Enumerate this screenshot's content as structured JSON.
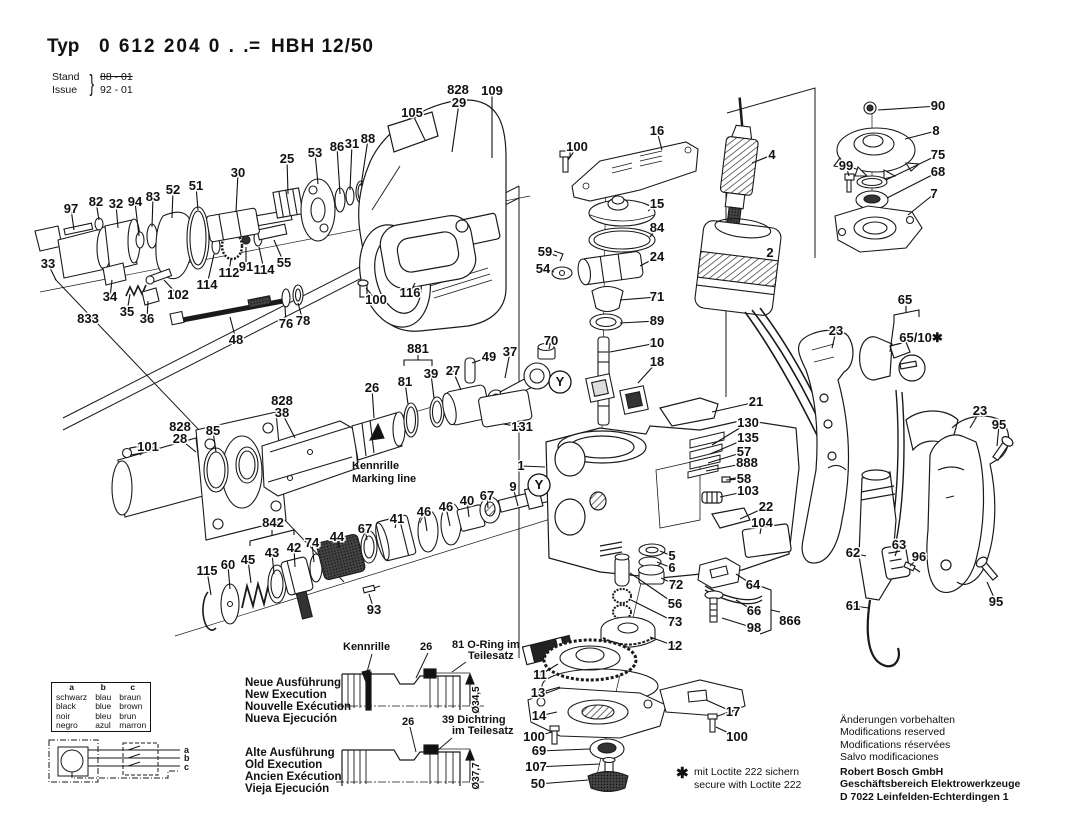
{
  "header": {
    "typ_label": "Typ",
    "typ_value": "0 612 204 0 . .",
    "equals": "=",
    "model": "HBH 12/50",
    "stand_label": "Stand",
    "issue_label": "Issue",
    "brace": "}",
    "stand_value": "88 - 01",
    "issue_value": "92 - 01"
  },
  "colors": {
    "ink": "#1a1a1a",
    "label": "#111111",
    "background": "#ffffff"
  },
  "notes": {
    "kennrille": [
      "Kennrille",
      "Marking line"
    ],
    "loctite_star": "✱",
    "loctite": [
      "mit Loctite 222 sichern",
      "secure with Loctite 222"
    ]
  },
  "executions": {
    "new": {
      "names": [
        "Neue Ausführung",
        "New Execution",
        "Nouvelle Exécution",
        "Nueva Ejecución"
      ],
      "callout_kennrille": "Kennrille",
      "callout_26": "26",
      "callout_81": "81 O-Ring im",
      "callout_81b": "Teilesatz",
      "dia": "Ø34,5"
    },
    "old": {
      "names": [
        "Alte Ausführung",
        "Old Execution",
        "Ancien Exécution",
        "Vieja Ejecución"
      ],
      "callout_26": "26",
      "callout_39": "39 Dichtring",
      "callout_39b": "im Teilesatz",
      "dia": "Ø37,7"
    }
  },
  "color_table": {
    "headers": [
      "a",
      "b",
      "c"
    ],
    "rows": [
      [
        "schwarz",
        "blau",
        "braun"
      ],
      [
        "black",
        "blue",
        "brown"
      ],
      [
        "noir",
        "bleu",
        "brun"
      ],
      [
        "negro",
        "azul",
        "marron"
      ]
    ]
  },
  "wiring": {
    "terminals": [
      "a",
      "b",
      "c"
    ]
  },
  "footer": {
    "notices": [
      "Änderungen vorbehalten",
      "Modifications reserved",
      "Modifications réservées",
      "Salvo modificaciones"
    ],
    "company": [
      "Robert Bosch GmbH",
      "Geschäftsbereich Elektrowerkzeuge",
      "D 7022 Leinfelden-Echterdingen 1"
    ]
  },
  "y_markers": [
    {
      "x": 560,
      "y": 382
    },
    {
      "x": 539,
      "y": 485
    }
  ],
  "part_labels": [
    {
      "t": "105",
      "x": 412,
      "y": 113,
      "lx": 425,
      "ly": 140
    },
    {
      "t": "828",
      "x": 458,
      "y": 90
    },
    {
      "t": "29",
      "x": 459,
      "y": 103,
      "lx": 452,
      "ly": 152
    },
    {
      "t": "109",
      "x": 492,
      "y": 91,
      "lx": 492,
      "ly": 158
    },
    {
      "t": "88",
      "x": 368,
      "y": 139,
      "lx": 361,
      "ly": 186
    },
    {
      "t": "31",
      "x": 352,
      "y": 144,
      "lx": 350,
      "ly": 190
    },
    {
      "t": "86",
      "x": 337,
      "y": 147,
      "lx": 340,
      "ly": 194
    },
    {
      "t": "53",
      "x": 315,
      "y": 153,
      "lx": 318,
      "ly": 184
    },
    {
      "t": "25",
      "x": 287,
      "y": 159,
      "lx": 288,
      "ly": 194
    },
    {
      "t": "30",
      "x": 238,
      "y": 173,
      "lx": 236,
      "ly": 212
    },
    {
      "t": "51",
      "x": 196,
      "y": 186,
      "lx": 198,
      "ly": 210
    },
    {
      "t": "52",
      "x": 173,
      "y": 190,
      "lx": 172,
      "ly": 218
    },
    {
      "t": "83",
      "x": 153,
      "y": 197,
      "lx": 152,
      "ly": 227
    },
    {
      "t": "94",
      "x": 135,
      "y": 202,
      "lx": 139,
      "ly": 236
    },
    {
      "t": "32",
      "x": 116,
      "y": 204,
      "lx": 118,
      "ly": 228
    },
    {
      "t": "82",
      "x": 96,
      "y": 202,
      "lx": 99,
      "ly": 220
    },
    {
      "t": "97",
      "x": 71,
      "y": 209,
      "lx": 74,
      "ly": 230
    },
    {
      "t": "33",
      "x": 48,
      "y": 264,
      "lx": 56,
      "ly": 280
    },
    {
      "t": "34",
      "x": 110,
      "y": 297,
      "lx": 112,
      "ly": 280
    },
    {
      "t": "35",
      "x": 127,
      "y": 312,
      "lx": 130,
      "ly": 294
    },
    {
      "t": "36",
      "x": 147,
      "y": 319,
      "lx": 148,
      "ly": 301
    },
    {
      "t": "833",
      "x": 88,
      "y": 319
    },
    {
      "t": "102",
      "x": 178,
      "y": 295,
      "lx": 164,
      "ly": 280
    },
    {
      "t": "114",
      "x": 207,
      "y": 285,
      "lx": 214,
      "ly": 254
    },
    {
      "t": "112",
      "x": 229,
      "y": 273,
      "lx": 231,
      "ly": 258
    },
    {
      "t": "91",
      "x": 246,
      "y": 267,
      "lx": 246,
      "ly": 247
    },
    {
      "t": "114",
      "x": 264,
      "y": 270,
      "lx": 259,
      "ly": 247
    },
    {
      "t": "55",
      "x": 284,
      "y": 263,
      "lx": 274,
      "ly": 240
    },
    {
      "t": "76",
      "x": 286,
      "y": 324,
      "lx": 285,
      "ly": 306
    },
    {
      "t": "78",
      "x": 303,
      "y": 321,
      "lx": 298,
      "ly": 303
    },
    {
      "t": "48",
      "x": 236,
      "y": 340,
      "lx": 230,
      "ly": 317
    },
    {
      "t": "100",
      "x": 376,
      "y": 300,
      "lx": 366,
      "ly": 288
    },
    {
      "t": "116",
      "x": 410,
      "y": 293,
      "lx": 415,
      "ly": 283
    },
    {
      "t": "100",
      "x": 577,
      "y": 147,
      "lx": 568,
      "ly": 160
    },
    {
      "t": "16",
      "x": 657,
      "y": 131,
      "lx": 662,
      "ly": 150
    },
    {
      "t": "15",
      "x": 657,
      "y": 204,
      "lx": 648,
      "ly": 211
    },
    {
      "t": "84",
      "x": 657,
      "y": 228,
      "lx": 650,
      "ly": 237
    },
    {
      "t": "24",
      "x": 657,
      "y": 257,
      "lx": 640,
      "ly": 266
    },
    {
      "t": "59",
      "x": 545,
      "y": 252,
      "lx": 557,
      "ly": 256
    },
    {
      "t": "54",
      "x": 543,
      "y": 269,
      "lx": 554,
      "ly": 272
    },
    {
      "t": "71",
      "x": 657,
      "y": 297,
      "lx": 620,
      "ly": 300
    },
    {
      "t": "89",
      "x": 657,
      "y": 321,
      "lx": 620,
      "ly": 323
    },
    {
      "t": "10",
      "x": 657,
      "y": 343,
      "lx": 610,
      "ly": 352
    },
    {
      "t": "18",
      "x": 657,
      "y": 362,
      "lx": 638,
      "ly": 383
    },
    {
      "t": "70",
      "x": 551,
      "y": 341,
      "lx": 549,
      "ly": 349
    },
    {
      "t": "90",
      "x": 938,
      "y": 106,
      "lx": 878,
      "ly": 110
    },
    {
      "t": "8",
      "x": 936,
      "y": 131,
      "lx": 905,
      "ly": 139
    },
    {
      "t": "75",
      "x": 938,
      "y": 155,
      "lx": 886,
      "ly": 180
    },
    {
      "t": "68",
      "x": 938,
      "y": 172,
      "lx": 887,
      "ly": 198
    },
    {
      "t": "7",
      "x": 934,
      "y": 194,
      "lx": 908,
      "ly": 215
    },
    {
      "t": "99",
      "x": 846,
      "y": 166,
      "lx": 849,
      "ly": 176
    },
    {
      "t": "4",
      "x": 772,
      "y": 155,
      "lx": 752,
      "ly": 163
    },
    {
      "t": "2",
      "x": 770,
      "y": 253,
      "lx": 768,
      "ly": 258
    },
    {
      "t": "65",
      "x": 905,
      "y": 300
    },
    {
      "t": "65/10✱",
      "x": 921,
      "y": 338
    },
    {
      "t": "23",
      "x": 836,
      "y": 331,
      "lx": 832,
      "ly": 348
    },
    {
      "t": "23",
      "x": 980,
      "y": 411,
      "lx": 970,
      "ly": 428
    },
    {
      "t": "95",
      "x": 999,
      "y": 425,
      "lx": 997,
      "ly": 446
    },
    {
      "t": "95",
      "x": 996,
      "y": 602,
      "lx": 987,
      "ly": 582
    },
    {
      "t": "62",
      "x": 853,
      "y": 553,
      "lx": 866,
      "ly": 556
    },
    {
      "t": "63",
      "x": 899,
      "y": 545,
      "lx": 895,
      "ly": 556
    },
    {
      "t": "96",
      "x": 919,
      "y": 557,
      "lx": 910,
      "ly": 566
    },
    {
      "t": "61",
      "x": 853,
      "y": 606,
      "lx": 869,
      "ly": 608
    },
    {
      "t": "881",
      "x": 418,
      "y": 349
    },
    {
      "t": "81",
      "x": 405,
      "y": 382,
      "lx": 408,
      "ly": 404
    },
    {
      "t": "39",
      "x": 431,
      "y": 374,
      "lx": 434,
      "ly": 398
    },
    {
      "t": "27",
      "x": 453,
      "y": 371,
      "lx": 461,
      "ly": 390
    },
    {
      "t": "49",
      "x": 489,
      "y": 357,
      "lx": 472,
      "ly": 363
    },
    {
      "t": "37",
      "x": 510,
      "y": 352,
      "lx": 505,
      "ly": 378
    },
    {
      "t": "26",
      "x": 372,
      "y": 388,
      "lx": 374,
      "ly": 418
    },
    {
      "t": "828",
      "x": 282,
      "y": 401
    },
    {
      "t": "38",
      "x": 282,
      "y": 413,
      "lx": 295,
      "ly": 438
    },
    {
      "t": "828",
      "x": 180,
      "y": 427
    },
    {
      "t": "28",
      "x": 180,
      "y": 439,
      "lx": 196,
      "ly": 452
    },
    {
      "t": "85",
      "x": 213,
      "y": 431,
      "lx": 216,
      "ly": 452
    },
    {
      "t": "101",
      "x": 148,
      "y": 447,
      "lx": 140,
      "ly": 455
    },
    {
      "t": "131",
      "x": 522,
      "y": 427,
      "lx": 503,
      "ly": 424
    },
    {
      "t": "1",
      "x": 521,
      "y": 466,
      "lx": 545,
      "ly": 467
    },
    {
      "t": "9",
      "x": 513,
      "y": 487,
      "lx": 518,
      "ly": 506
    },
    {
      "t": "46",
      "x": 424,
      "y": 512,
      "lx": 427,
      "ly": 531
    },
    {
      "t": "46",
      "x": 446,
      "y": 507,
      "lx": 450,
      "ly": 526
    },
    {
      "t": "40",
      "x": 467,
      "y": 501,
      "lx": 469,
      "ly": 517
    },
    {
      "t": "67",
      "x": 487,
      "y": 496,
      "lx": 488,
      "ly": 508
    },
    {
      "t": "842",
      "x": 273,
      "y": 523
    },
    {
      "t": "45",
      "x": 248,
      "y": 560,
      "lx": 251,
      "ly": 583
    },
    {
      "t": "43",
      "x": 272,
      "y": 553,
      "lx": 274,
      "ly": 574
    },
    {
      "t": "42",
      "x": 294,
      "y": 548,
      "lx": 295,
      "ly": 567
    },
    {
      "t": "74",
      "x": 312,
      "y": 543,
      "lx": 314,
      "ly": 562
    },
    {
      "t": "44",
      "x": 337,
      "y": 537,
      "lx": 339,
      "ly": 548
    },
    {
      "t": "67",
      "x": 365,
      "y": 529,
      "lx": 367,
      "ly": 540
    },
    {
      "t": "41",
      "x": 397,
      "y": 519,
      "lx": 395,
      "ly": 528
    },
    {
      "t": "115",
      "x": 207,
      "y": 571,
      "lx": 211,
      "ly": 595
    },
    {
      "t": "60",
      "x": 228,
      "y": 565,
      "lx": 230,
      "ly": 589
    },
    {
      "t": "93",
      "x": 374,
      "y": 610,
      "lx": 369,
      "ly": 594
    },
    {
      "t": "21",
      "x": 756,
      "y": 402,
      "lx": 712,
      "ly": 412
    },
    {
      "t": "130",
      "x": 748,
      "y": 423,
      "lx": 712,
      "ly": 445
    },
    {
      "t": "135",
      "x": 748,
      "y": 438,
      "lx": 710,
      "ly": 454
    },
    {
      "t": "57",
      "x": 744,
      "y": 452,
      "lx": 708,
      "ly": 463
    },
    {
      "t": "888",
      "x": 747,
      "y": 463,
      "lx": 706,
      "ly": 471
    },
    {
      "t": "58",
      "x": 744,
      "y": 479,
      "lx": 726,
      "ly": 480
    },
    {
      "t": "103",
      "x": 748,
      "y": 491,
      "lx": 720,
      "ly": 497
    },
    {
      "t": "22",
      "x": 766,
      "y": 507,
      "lx": 740,
      "ly": 519
    },
    {
      "t": "104",
      "x": 762,
      "y": 523,
      "lx": 760,
      "ly": 534
    },
    {
      "t": "5",
      "x": 672,
      "y": 556,
      "lx": 660,
      "ly": 551
    },
    {
      "t": "6",
      "x": 672,
      "y": 568,
      "lx": 657,
      "ly": 562
    },
    {
      "t": "72",
      "x": 676,
      "y": 585,
      "lx": 661,
      "ly": 578
    },
    {
      "t": "56",
      "x": 675,
      "y": 604,
      "lx": 630,
      "ly": 573
    },
    {
      "t": "73",
      "x": 675,
      "y": 622,
      "lx": 631,
      "ly": 600
    },
    {
      "t": "12",
      "x": 675,
      "y": 646,
      "lx": 650,
      "ly": 637
    },
    {
      "t": "64",
      "x": 753,
      "y": 585,
      "lx": 736,
      "ly": 574
    },
    {
      "t": "66",
      "x": 754,
      "y": 611,
      "lx": 736,
      "ly": 600
    },
    {
      "t": "98",
      "x": 754,
      "y": 628,
      "lx": 722,
      "ly": 618
    },
    {
      "t": "866",
      "x": 790,
      "y": 621
    },
    {
      "t": "11",
      "x": 540,
      "y": 675,
      "lx": 558,
      "ly": 664
    },
    {
      "t": "13",
      "x": 538,
      "y": 693,
      "lx": 560,
      "ly": 687
    },
    {
      "t": "14",
      "x": 539,
      "y": 716,
      "lx": 557,
      "ly": 712
    },
    {
      "t": "100",
      "x": 534,
      "y": 737,
      "lx": 552,
      "ly": 732
    },
    {
      "t": "69",
      "x": 539,
      "y": 751,
      "lx": 590,
      "ly": 749
    },
    {
      "t": "107",
      "x": 536,
      "y": 767,
      "lx": 600,
      "ly": 764
    },
    {
      "t": "50",
      "x": 538,
      "y": 784,
      "lx": 588,
      "ly": 780
    },
    {
      "t": "17",
      "x": 733,
      "y": 712,
      "lx": 706,
      "ly": 700
    },
    {
      "t": "100",
      "x": 737,
      "y": 737,
      "lx": 716,
      "ly": 727
    }
  ]
}
